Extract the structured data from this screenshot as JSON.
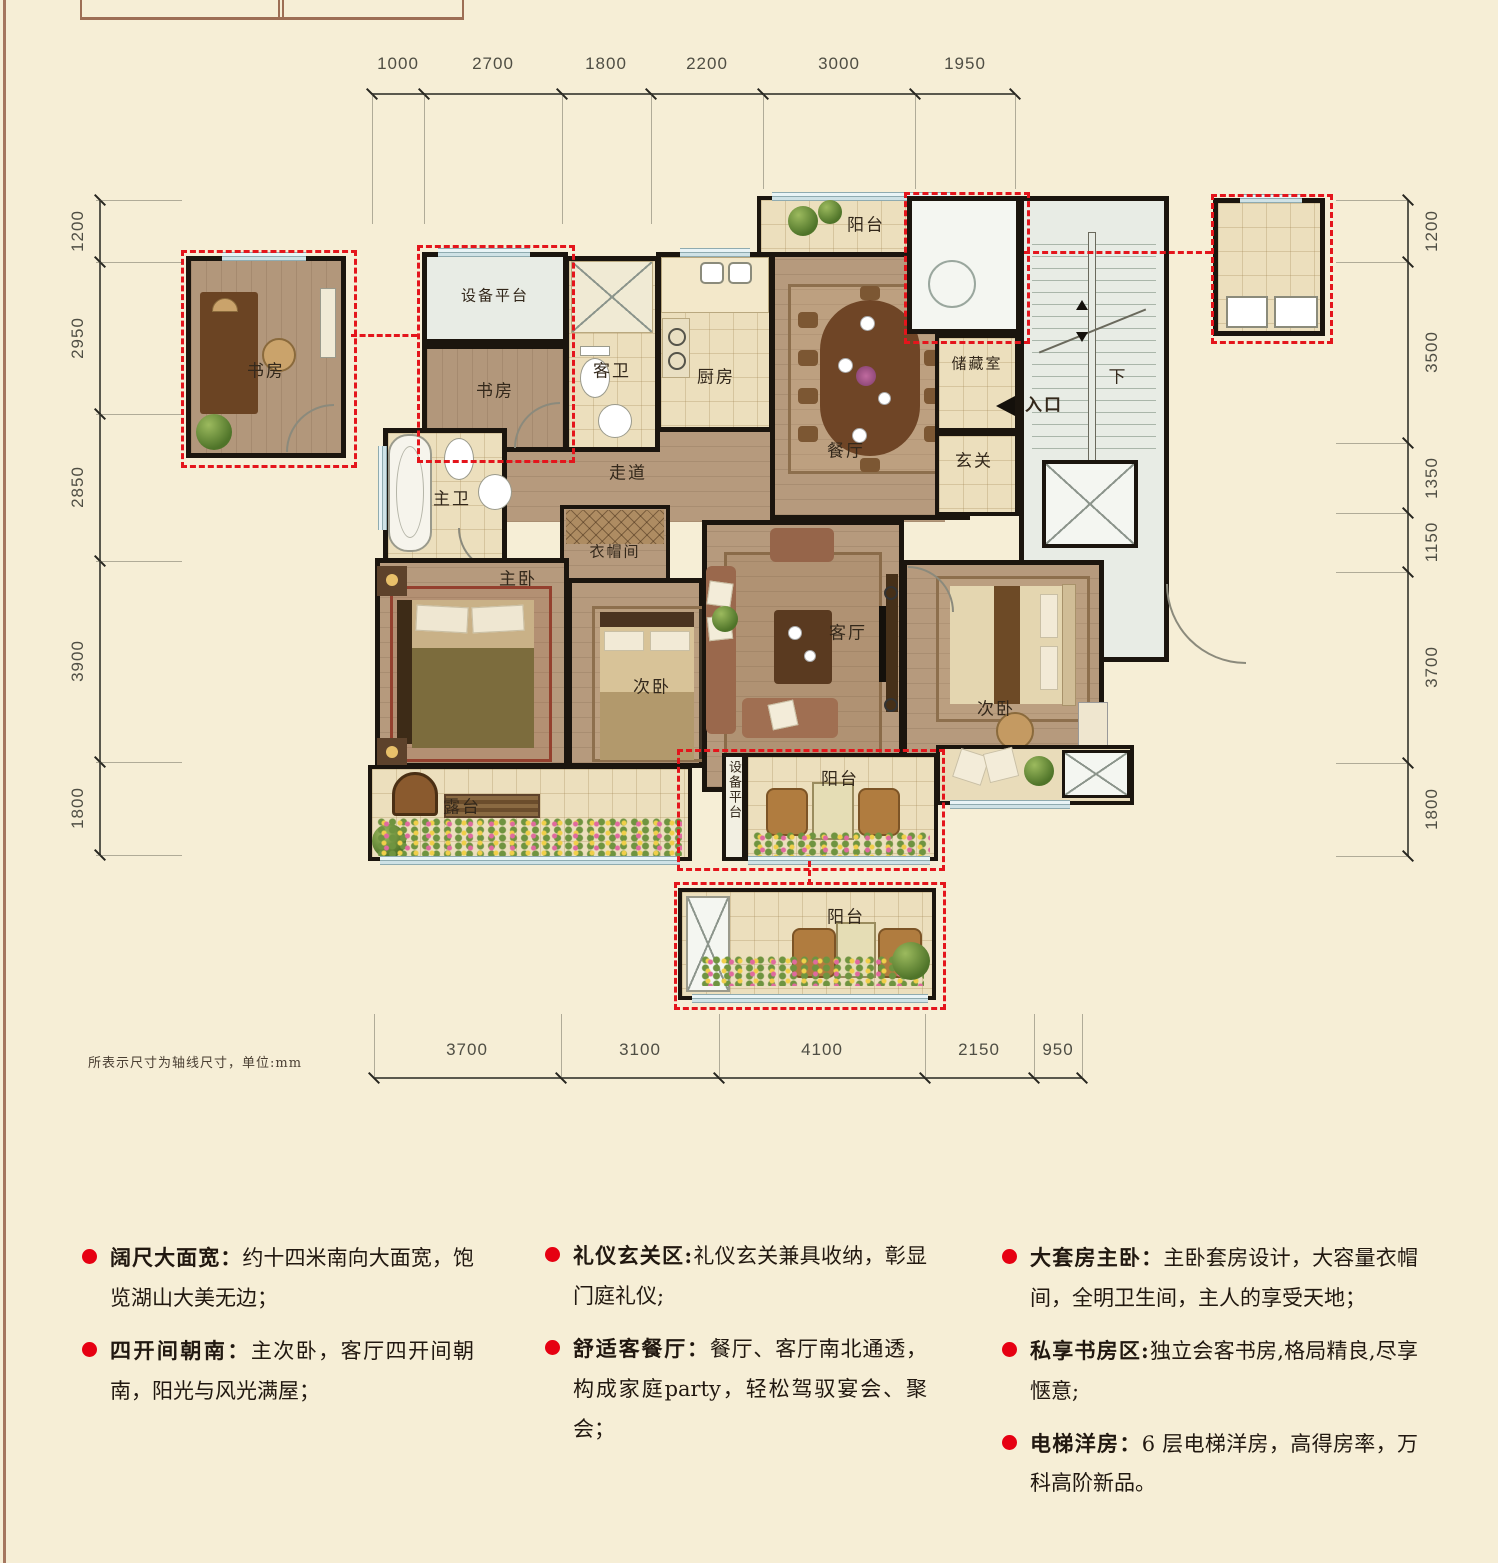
{
  "page": {
    "note": "所表示尺寸为轴线尺寸，单位:mm"
  },
  "dimensions": {
    "top": [
      "1000",
      "2700",
      "1800",
      "2200",
      "3000",
      "1950"
    ],
    "bottom": [
      "3700",
      "3100",
      "4100",
      "2150",
      "950"
    ],
    "left": [
      "1200",
      "2950",
      "2850",
      "3900",
      "1800"
    ],
    "right": [
      "1200",
      "3500",
      "1350",
      "1150",
      "3700",
      "1800"
    ]
  },
  "rooms": {
    "study_gift": "书房",
    "equipment_platform_top": "设备平台",
    "study": "书房",
    "guest_bath": "客卫",
    "kitchen": "厨房",
    "balcony_north": "阳台",
    "dining": "餐厅",
    "storage": "储藏室",
    "foyer": "玄关",
    "corridor": "走道",
    "master_bath": "主卫",
    "cloakroom": "衣帽间",
    "master_bedroom": "主卧",
    "bedroom_mid": "次卧",
    "living_room": "客厅",
    "bedroom_east": "次卧",
    "terrace": "露台",
    "equipment_platform_south": "设备平台",
    "balcony_south": "阳台",
    "balcony_gift": "阳台",
    "entrance": "入口",
    "stair_down": "下"
  },
  "features": {
    "col1": [
      {
        "label": "阔尺大面宽：",
        "text": "约十四米南向大面宽，饱览湖山大美无边；"
      },
      {
        "label": "四开间朝南：",
        "text": "主次卧，客厅四开间朝南，阳光与风光满屋；"
      }
    ],
    "col2": [
      {
        "label": "礼仪玄关区:",
        "text": "礼仪玄关兼具收纳，彰显门庭礼仪;"
      },
      {
        "label": "舒适客餐厅：",
        "text": "餐厅、客厅南北通透，构成家庭party，轻松驾驭宴会、聚会；"
      }
    ],
    "col3": [
      {
        "label": "大套房主卧：",
        "text": "主卧套房设计，大容量衣帽间，全明卫生间，主人的享受天地；"
      },
      {
        "label": "私享书房区:",
        "text": "独立会客书房,格局精良,尽享惬意;"
      },
      {
        "label": "电梯洋房：",
        "text": "6 层电梯洋房，高得房率，万科高阶新品。"
      }
    ]
  }
}
